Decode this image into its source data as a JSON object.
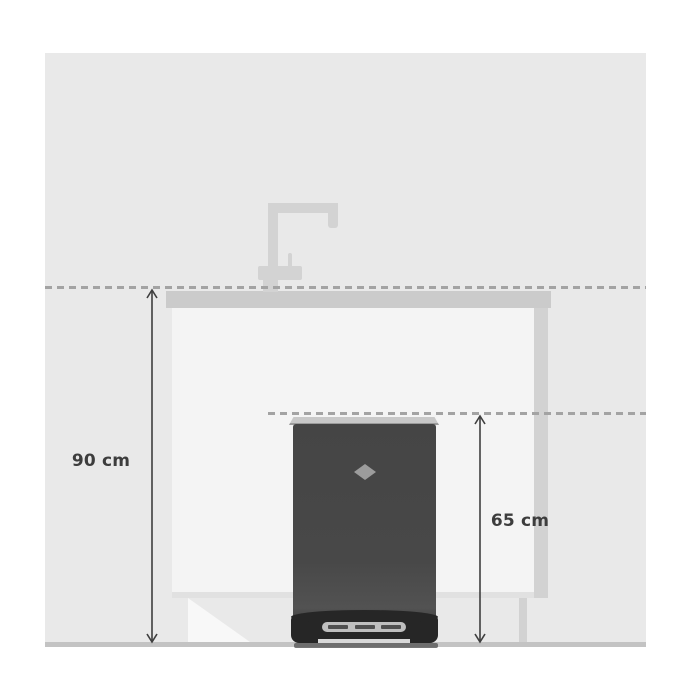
{
  "scene": {
    "description": "Side-view dimension diagram of a kitchen counter with faucet and a freestanding pedal bin under the worktop",
    "colors": {
      "background": "#ffffff",
      "wall": "#e9e9e9",
      "counter": "#cbcbcb",
      "cabinet_front": "#f4f4f4",
      "faucet": "#d3d3d3",
      "bin_body": "#474747",
      "bin_base": "#262626",
      "bin_logo": "#9c9c9c",
      "dashed_line": "#a3a3a3",
      "dimension_line": "#3f3f3f",
      "label_text": "#3d3d3d",
      "floor_line": "#c3c3c3"
    }
  },
  "measurements": [
    {
      "id": "counter-height",
      "label": "90 cm",
      "value": 90,
      "unit": "cm"
    },
    {
      "id": "bin-height",
      "label": "65 cm",
      "value": 65,
      "unit": "cm"
    }
  ]
}
